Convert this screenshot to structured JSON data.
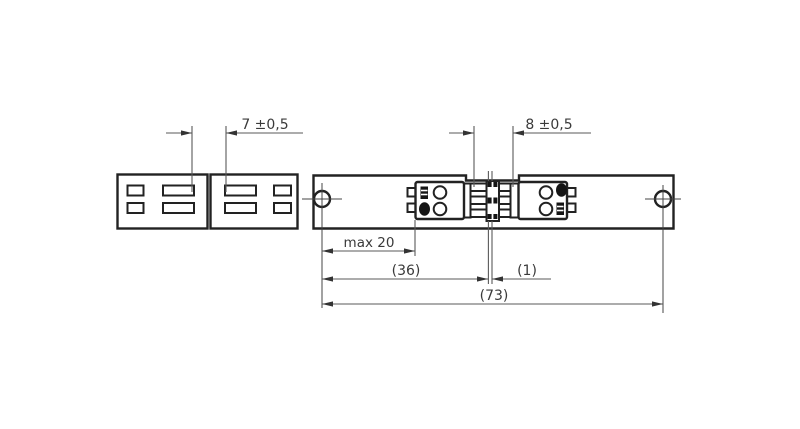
{
  "colors": {
    "background": "#ffffff",
    "outline": "#222222",
    "dimension_line": "#5a5a5a",
    "text": "#3a3a3a",
    "dark_fill": "#151515"
  },
  "dimensions": {
    "d7": {
      "label": "7 ±0,5"
    },
    "d8": {
      "label": "8 ±0,5"
    },
    "dmax20": {
      "label": "max 20"
    },
    "d36": {
      "label": "(36)"
    },
    "d1": {
      "label": "(1)"
    },
    "d73": {
      "label": "(73)"
    }
  }
}
